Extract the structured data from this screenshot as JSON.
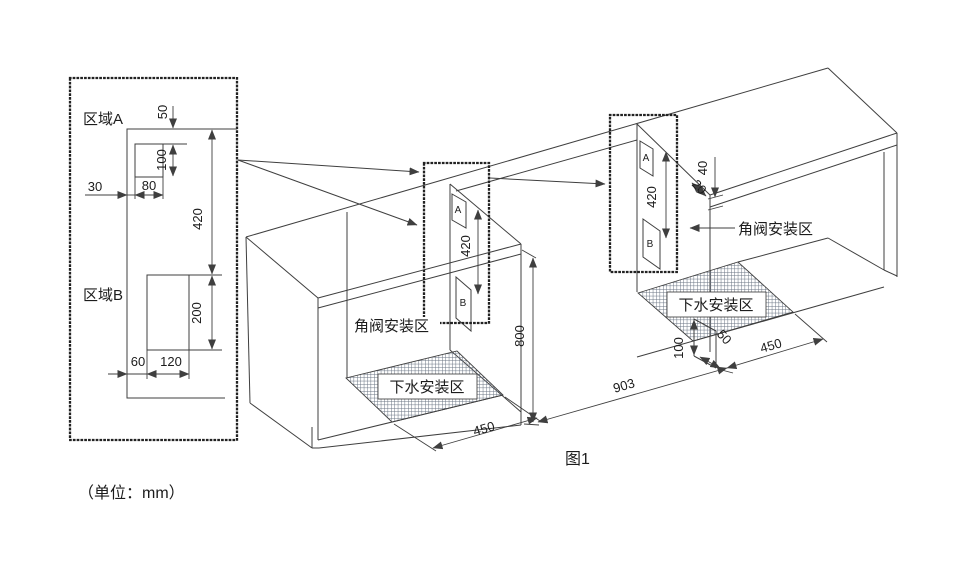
{
  "figure": {
    "caption": "图1",
    "unit_note": "（单位：mm）",
    "colors": {
      "line": "#3f3f3f",
      "hatch": "#6a7483",
      "text": "#1c1c1c"
    },
    "detail": {
      "zone_a": "区域A",
      "zone_b": "区域B",
      "d50": "50",
      "d100": "100",
      "d30": "30",
      "d80": "80",
      "d420": "420",
      "d200": "200",
      "d60": "60",
      "d120": "120"
    },
    "mid": {
      "a": "A",
      "b": "B",
      "d420": "420",
      "d800": "800",
      "d450": "450",
      "valve": "角阀安装区",
      "drain": "下水安装区"
    },
    "right": {
      "a": "A",
      "b": "B",
      "d420": "420",
      "d20": "20",
      "d40": "40",
      "d100": "100",
      "d50": "50",
      "d450": "450",
      "d903": "903",
      "valve": "角阀安装区",
      "drain": "下水安装区"
    }
  }
}
